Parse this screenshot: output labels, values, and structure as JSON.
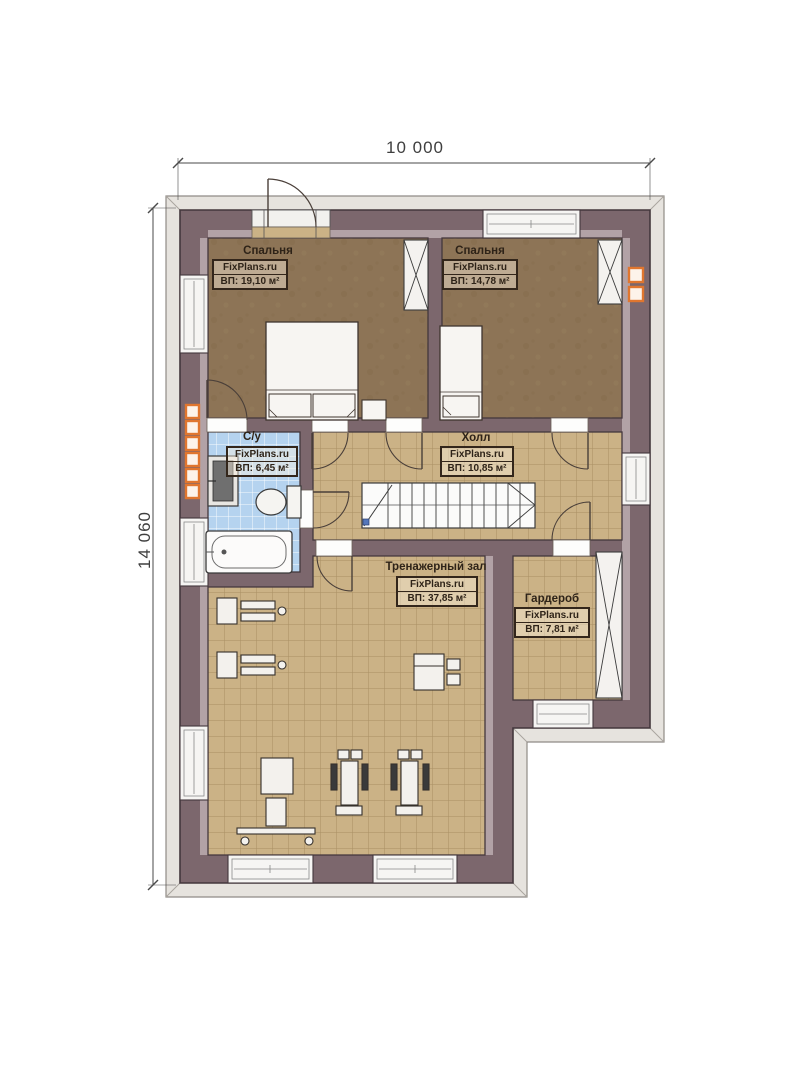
{
  "plan": {
    "watermark": "FixPlans.ru",
    "type_note": "floor plan drawing"
  },
  "dimensions": {
    "width_label": "10 000",
    "height_label": "14 060"
  },
  "rooms": [
    {
      "id": "bedroom-1",
      "name": "Спальня",
      "watermark": "FixPlans.ru",
      "area": "ВП: 19,10 м²"
    },
    {
      "id": "bedroom-2",
      "name": "Спальня",
      "watermark": "FixPlans.ru",
      "area": "ВП: 14,78 м²"
    },
    {
      "id": "bathroom",
      "name": "С/у",
      "watermark": "FixPlans.ru",
      "area": "ВП: 6,45 м²"
    },
    {
      "id": "hall",
      "name": "Холл",
      "watermark": "FixPlans.ru",
      "area": "ВП: 10,85 м²"
    },
    {
      "id": "gym",
      "name": "Тренажерный зал",
      "watermark": "FixPlans.ru",
      "area": "ВП: 37,85 м²"
    },
    {
      "id": "wardrobe",
      "name": "Гардероб",
      "watermark": "FixPlans.ru",
      "area": "ВП: 7,81 м²"
    }
  ],
  "colors": {
    "wall": "#7c676d",
    "wall_outline": "#43373c",
    "wall_inner_band": "#b2a2a6",
    "bedroom_floor": "#8d7456",
    "tile_floor": "#cbb286",
    "tile_line": "#9c8357",
    "bath_tile": "#b5d3ef",
    "vent_accent": "#e0762f",
    "roof_band": "#e6e3de"
  }
}
